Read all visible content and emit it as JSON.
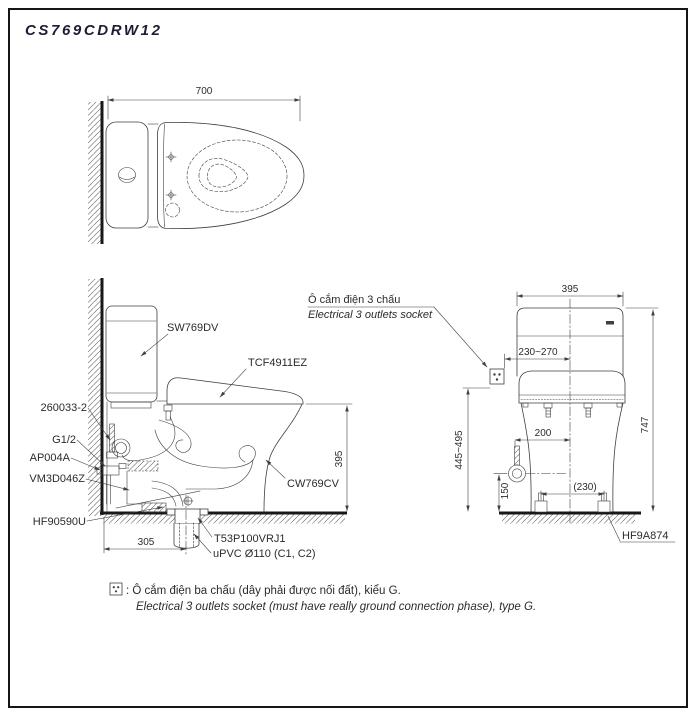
{
  "window": {
    "title": "CS769CDRW12"
  },
  "colors": {
    "title": "#1d1d33",
    "line": "#3f3f3f",
    "heavy": "#181818",
    "text": "#2b2b2b"
  },
  "top_view": {
    "dims": {
      "depth": "700"
    }
  },
  "side_view": {
    "dims": {
      "bowl_height": "395",
      "rough_in": "305"
    },
    "labels": {
      "cistern": "SW769DV",
      "washlet": "TCF4911EZ",
      "bowl": "CW769CV",
      "bolt": "260033-2",
      "thread": "G1/2",
      "stop_valve": "AP004A",
      "connector": "VM3D046Z",
      "gasket": "HF90590U",
      "flange": "T53P100VRJ1",
      "pipe": "uPVC Ø110 (C1, C2)"
    }
  },
  "socket_callout": {
    "vi": "Ô cắm điện 3 chấu",
    "en": "Electrical 3 outlets socket"
  },
  "rear_view": {
    "dims": {
      "tank_width": "395",
      "socket_offset": "230~270",
      "overall_height": "747",
      "socket_height": "445~495",
      "supply_offset": "200",
      "supply_height": "150",
      "bolt_pitch": "(230)"
    },
    "labels": {
      "cap": "HF9A874"
    }
  },
  "footnote": {
    "vi": ": Ô cắm điện ba chấu (dây phải được nối đất), kiểu G.",
    "en": "Electrical 3 outlets socket (must have really ground connection phase), type G."
  }
}
